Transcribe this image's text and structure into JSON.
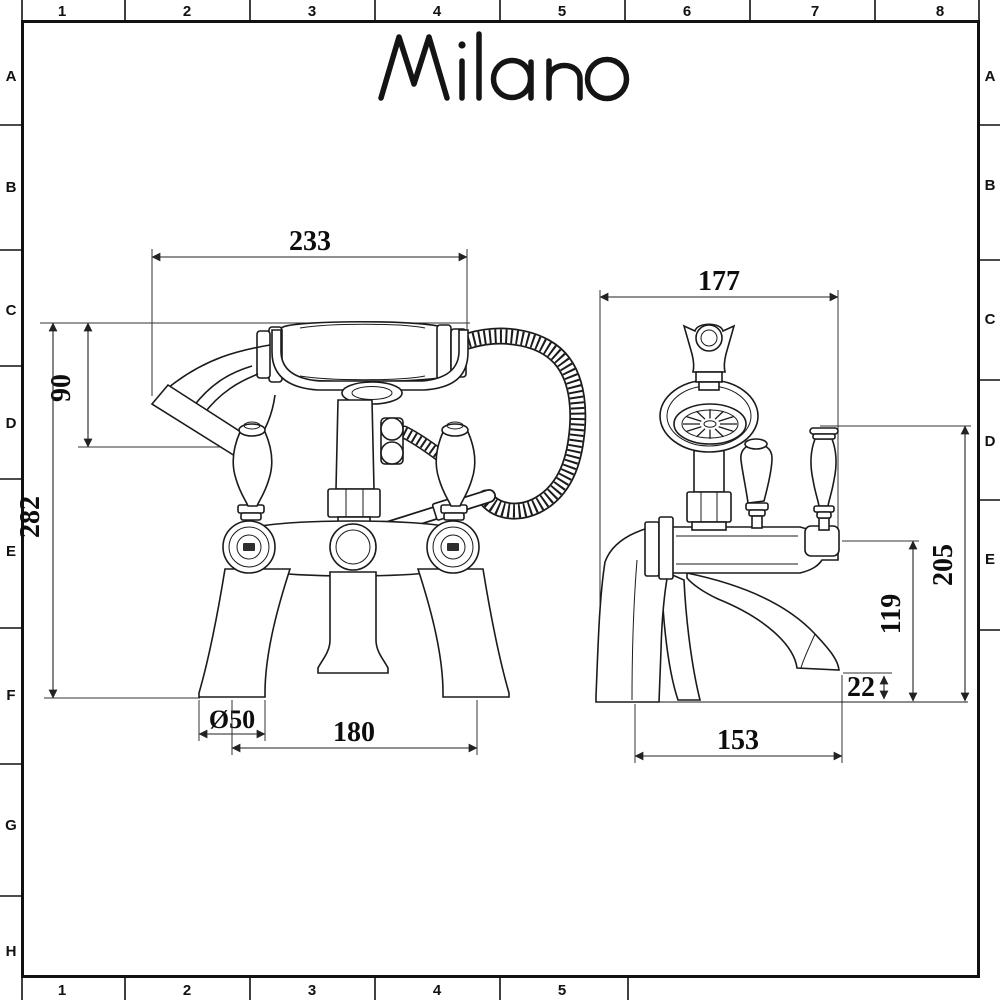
{
  "logo": {
    "brand": "Milano"
  },
  "grid": {
    "top": [
      "1",
      "2",
      "3",
      "4",
      "5",
      "6",
      "7",
      "8"
    ],
    "bottom": [
      "1",
      "2",
      "3",
      "4",
      "5"
    ],
    "left": [
      "A",
      "B",
      "C",
      "D",
      "E",
      "F",
      "G",
      "H"
    ],
    "right": [
      "A",
      "B",
      "C",
      "D",
      "E"
    ]
  },
  "dimensions_front": {
    "handset_span": "233",
    "handset_height": "90",
    "overall_height": "282",
    "base_diameter": "Ø50",
    "tap_centres": "180"
  },
  "dimensions_side": {
    "overall_depth": "177",
    "overall_height": "205",
    "spout_height": "119",
    "spout_overhang": "22",
    "base_depth": "153"
  },
  "colors": {
    "line": "#1b1b1b",
    "background": "#ffffff",
    "dimension_text": "#0d0d0d"
  }
}
